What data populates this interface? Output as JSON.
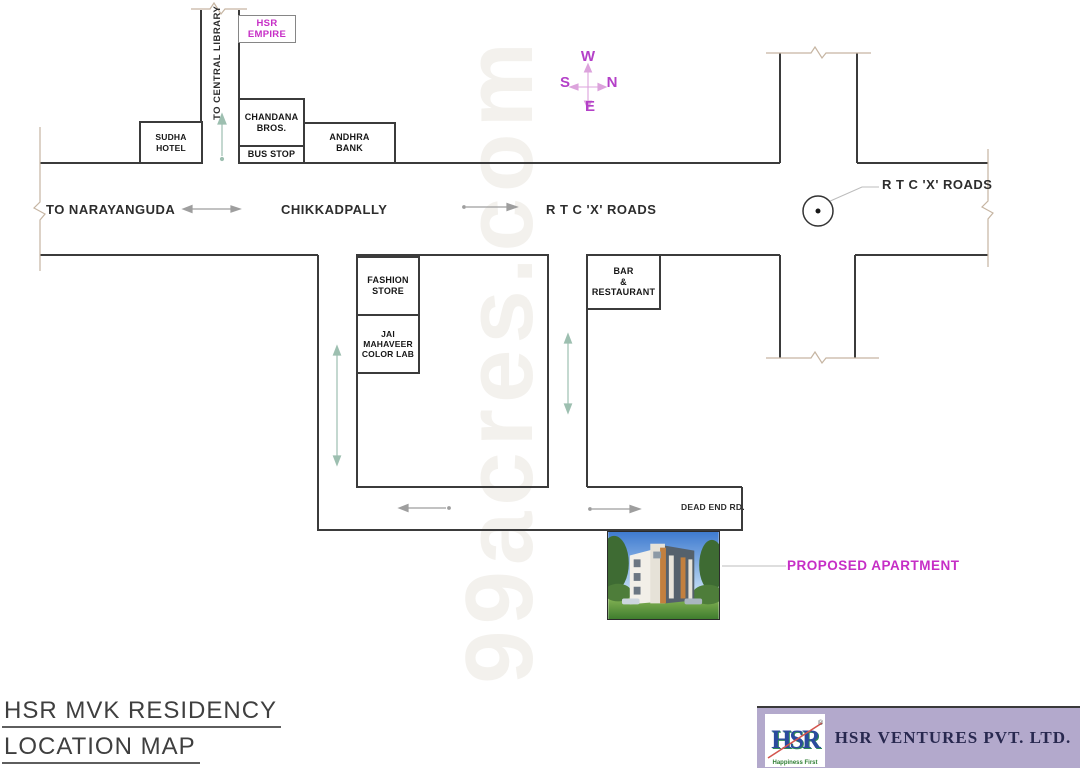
{
  "watermark": {
    "text": "99acres.com"
  },
  "compass": {
    "top": "W",
    "right": "N",
    "left": "S",
    "bottom": "E"
  },
  "roads": {
    "to_central_library": "TO CENTRAL LIBRARY",
    "to_narayanguda": "TO NARAYANGUDA",
    "chikkadpally": "CHIKKADPALLY",
    "rtc_x_roads": "R T C 'X' ROADS",
    "rtc_x_roads_callout": "R T C 'X' ROADS",
    "dead_end_rd": "DEAD END RD."
  },
  "buildings": {
    "hsr_empire": "HSR EMPIRE",
    "sudha_hotel": "SUDHA HOTEL",
    "chandana_bros": {
      "line1": "CHANDANA",
      "line2": "BROS."
    },
    "bus_stop": "BUS STOP",
    "andhra_bank": {
      "line1": "ANDHRA",
      "line2": "BANK"
    },
    "fashion_store": {
      "line1": "FASHION",
      "line2": "STORE"
    },
    "jai_mahaveer": {
      "line1": "JAI MAHAVEER",
      "line2": "COLOR LAB"
    },
    "bar_restaurant": {
      "line1": "BAR",
      "line2": "&",
      "line3": "RESTAURANT"
    }
  },
  "callouts": {
    "proposed_apartment": "PROPOSED APARTMENT"
  },
  "title_block": {
    "project": "HSR MVK RESIDENCY",
    "subtitle": "LOCATION MAP"
  },
  "footer": {
    "company": "HSR VENTURES PVT. LTD.",
    "logo": {
      "text": "HSR",
      "registered": "®",
      "tagline": "Happiness First"
    }
  },
  "colors": {
    "outline_dark": "#3b3b3b",
    "break_line_tan": "#c6b5a2",
    "magenta_accent": "#c62ec6",
    "compass_purple": "#b440c8",
    "arrow_teal": "#9dbfb0",
    "arrow_gray": "#9e9e9e",
    "panel_lavender": "#b3a9cc",
    "company_navy": "#28284f"
  }
}
